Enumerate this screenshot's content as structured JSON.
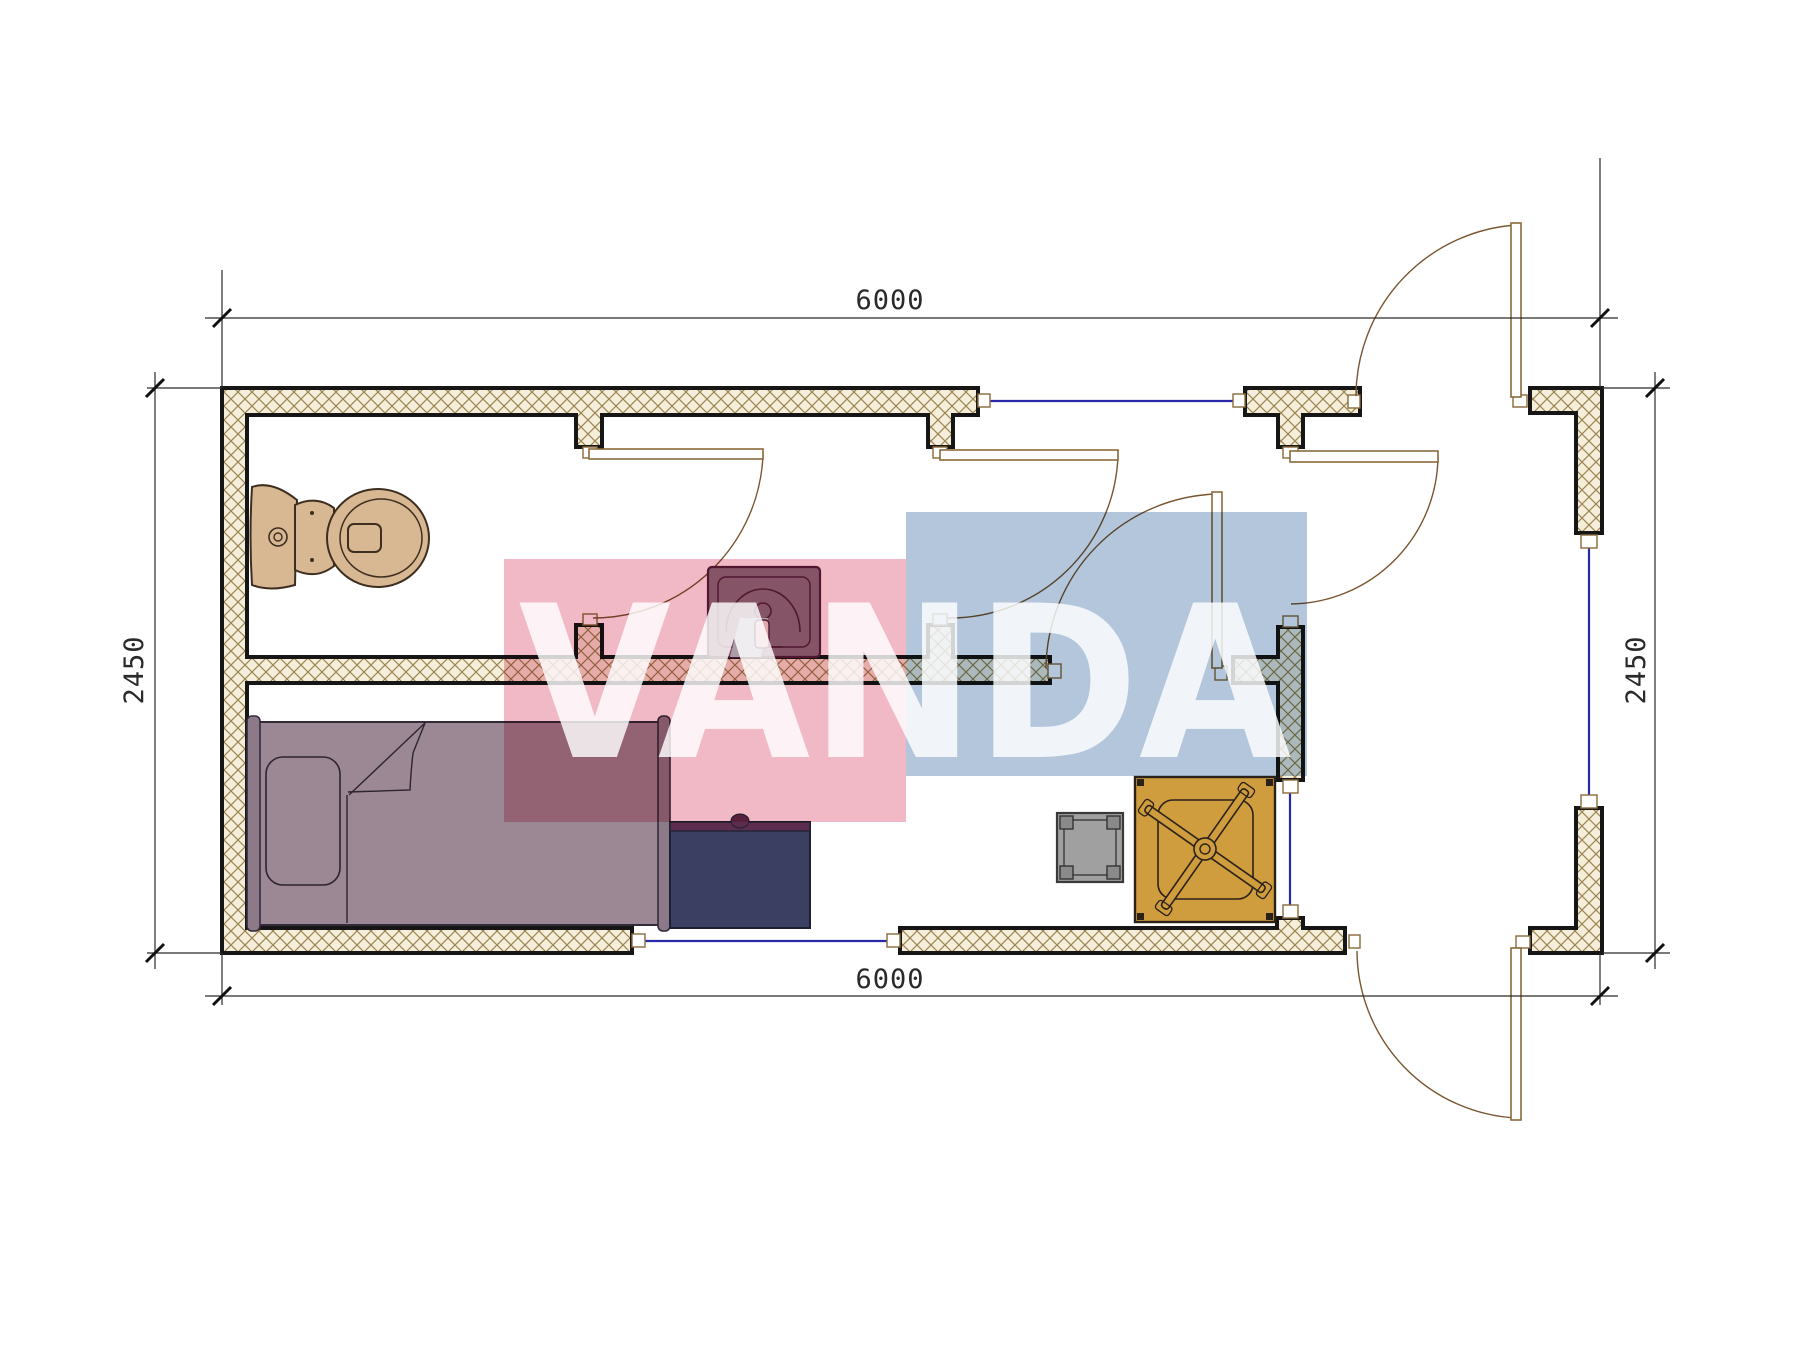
{
  "dimensions": {
    "top": {
      "label": "6000"
    },
    "bottom": {
      "label": "6000"
    },
    "left": {
      "label": "2450"
    },
    "right": {
      "label": "2450"
    }
  },
  "watermark": {
    "text": "VANDA",
    "pink": "#f1b9c6",
    "blue": "#b3c6dc",
    "letters": "#ffffff"
  },
  "palette": {
    "background": "#ffffff",
    "wall_fill": "#f4eeda",
    "wall_hatch": "#9c8552",
    "wall_border": "#161616",
    "window": "#2a2aa8",
    "door": "#7a5530",
    "dimension": "#2a2a2a",
    "toilet": "#d8b893",
    "toilet_line": "#3d2e20",
    "sink": "#8d7385",
    "sink_line": "#551f3e",
    "sink_accent": "#b5d8da",
    "bed": "#9c8794",
    "bed_line": "#342b3a",
    "bed_rail": "#8d7a89",
    "desk": "#3b4063",
    "desk_top": "#5c2d4e",
    "side_table": "#a0a0a0",
    "side_table_leg": "#8a8a8a",
    "side_table_line": "#3a3a3a",
    "fan_table": "#cf9c3e",
    "fan_table_line": "#2a2218"
  },
  "fixtures": [
    {
      "name": "toilet"
    },
    {
      "name": "washbasin"
    },
    {
      "name": "single-bed"
    },
    {
      "name": "desk"
    },
    {
      "name": "side-table"
    },
    {
      "name": "table-with-fan"
    }
  ]
}
